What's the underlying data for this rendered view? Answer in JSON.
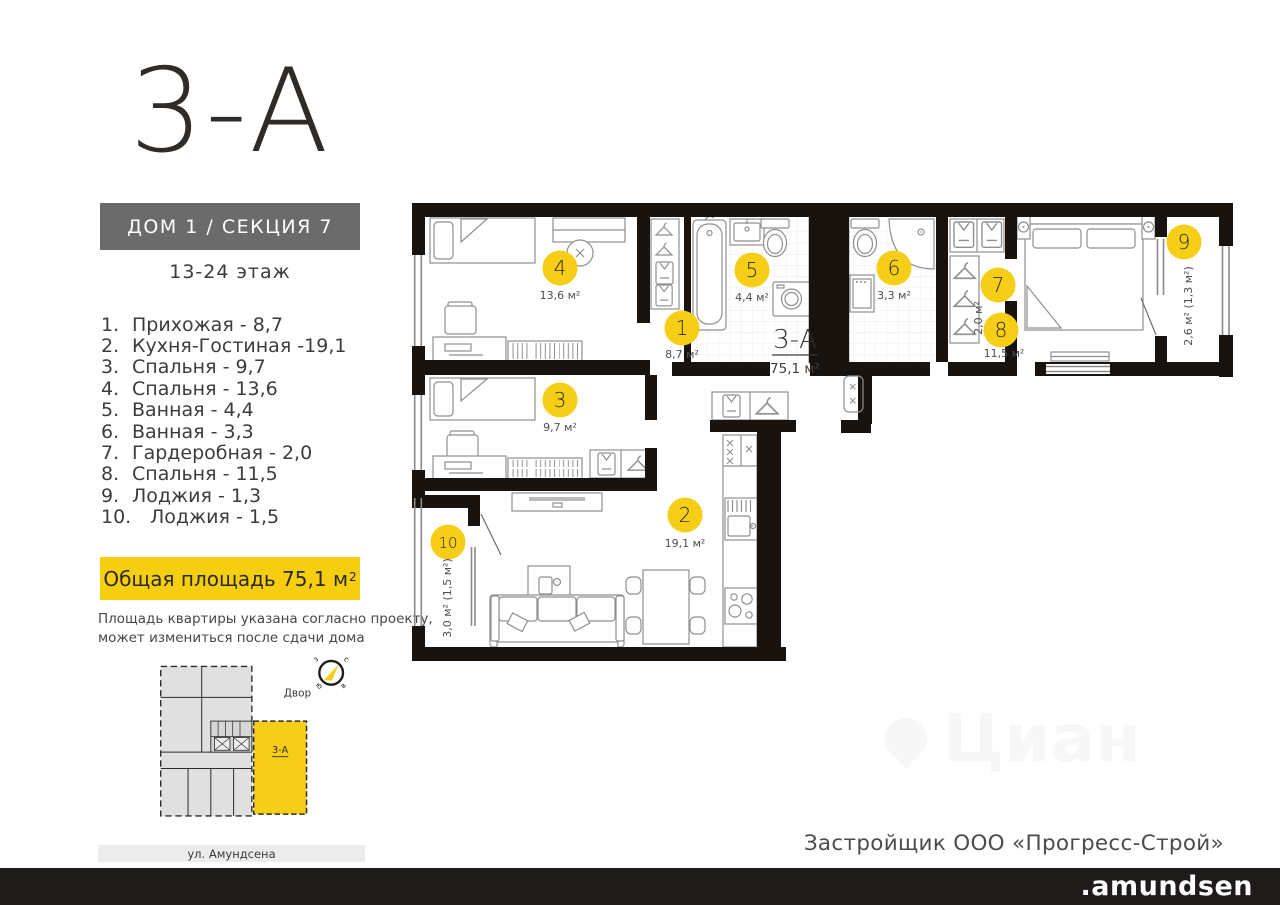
{
  "sidebar": {
    "title": "3-А",
    "building": "ДОМ 1 / СЕКЦИЯ 7",
    "floors": "13-24 этаж",
    "room_list": [
      {
        "num": "1.",
        "label": "Прихожая - 8,7"
      },
      {
        "num": "2.",
        "label": "Кухня-Гостиная -19,1"
      },
      {
        "num": "3.",
        "label": "Спальня - 9,7"
      },
      {
        "num": "4.",
        "label": "Спальня - 13,6"
      },
      {
        "num": "5.",
        "label": "Ванная - 4,4"
      },
      {
        "num": "6.",
        "label": "Ванная - 3,3"
      },
      {
        "num": "7.",
        "label": "Гардеробная - 2,0"
      },
      {
        "num": "8.",
        "label": "Спальня - 11,5"
      },
      {
        "num": "9.",
        "label": "Лоджия - 1,3"
      },
      {
        "num": "10.",
        "label": "Лоджия - 1,5"
      }
    ],
    "total_area_label": "Общая площадь 75,1 м",
    "total_area_sup": "2",
    "disclaimer_line1": "Площадь квартиры указана согласно проекту,",
    "disclaimer_line2": "может измениться после сдачи дома",
    "minimap": {
      "courtyard": "Двор",
      "unit": "3-А",
      "street": "ул. Амундсена",
      "compass": {
        "nw": "з",
        "ne": "с",
        "sw": "ю",
        "se": "в"
      }
    }
  },
  "plan": {
    "apartment_label": "3-А",
    "apartment_area": "75,1 м²",
    "markers": [
      {
        "num": "1",
        "area": "8,7 м²"
      },
      {
        "num": "2",
        "area": "19,1 м²"
      },
      {
        "num": "3",
        "area": "9,7 м²"
      },
      {
        "num": "4",
        "area": "13,6 м²"
      },
      {
        "num": "5",
        "area": "4,4 м²"
      },
      {
        "num": "6",
        "area": "3,3 м²"
      },
      {
        "num": "7",
        "area": "2,0 м²"
      },
      {
        "num": "8",
        "area": "11,5 м²"
      },
      {
        "num": "9",
        "area": "2,6 м² (1,3 м²)"
      },
      {
        "num": "10",
        "area": "3,0 м² (1,5 м²)"
      }
    ]
  },
  "watermark": "Циан",
  "footer": {
    "developer": "Застройщик ООО «Прогресс-Строй»",
    "brand": ".amundsen"
  },
  "colors": {
    "accent_yellow": "#F6CE17",
    "wall_black": "#18130E",
    "box_gray": "#6B6B6B",
    "footer_black": "#1E1B1A"
  }
}
